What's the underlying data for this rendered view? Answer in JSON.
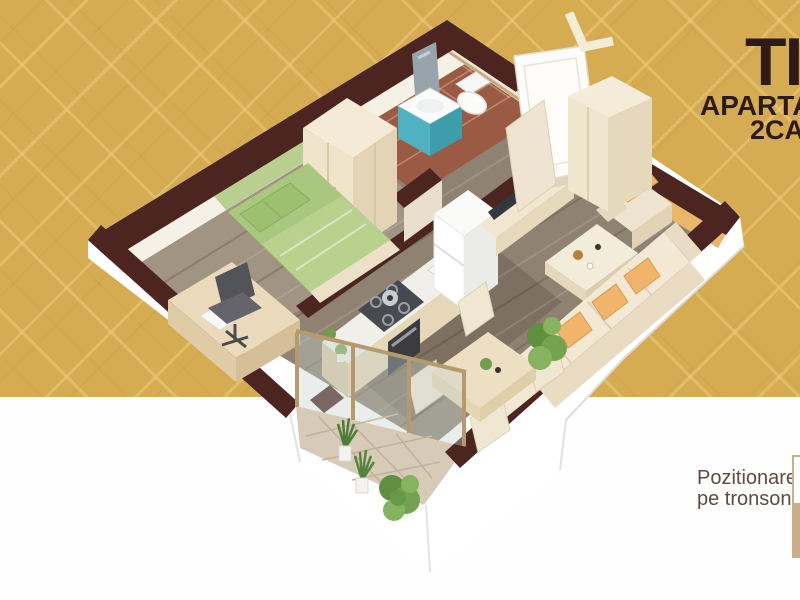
{
  "page": {
    "background_top_color": "#d6ac52",
    "background_bottom_color": "#fefefe",
    "background_pattern": "concentric-diamond-lattice",
    "split_y_px": 397
  },
  "header": {
    "title": "TIP",
    "subtitle_line1": "APARTAM",
    "subtitle_line2": "2CAM",
    "text_color": "#2e1a19",
    "note": "text is cropped by right edge of image"
  },
  "footer": {
    "label_line1": "Pozitionare",
    "label_line2": "pe tronson",
    "text_color": "#5d4b44",
    "tronson_marker_color": "#c9ae8a"
  },
  "floor_plan": {
    "type": "3d-isometric-apartment-render",
    "wall_cap_color": "#4c2420",
    "outer_wall_color": "#ffffff",
    "wood_floor_color": "#8f8273",
    "entrance_marker": "white-chevron-arrow",
    "rooms": [
      {
        "name": "bedroom",
        "floor": "wood",
        "furniture": [
          "wardrobe",
          "double-bed-green",
          "green-accent-wall",
          "desk",
          "laptop",
          "office-chair"
        ]
      },
      {
        "name": "bathroom",
        "floor": "terracotta-tile",
        "tile_color": "#9b5a43",
        "furniture": [
          "teal-vanity-sink",
          "mirror",
          "toilet"
        ],
        "vanity_color": "#4eb2c0"
      },
      {
        "name": "hallway",
        "floor": "wood",
        "furniture": [
          "entry-door-open",
          "bathroom-door",
          "tall-cabinet"
        ]
      },
      {
        "name": "kitchen",
        "floor": "wood",
        "furniture": [
          "counter",
          "gas-hob",
          "oven",
          "sink",
          "fridge",
          "potted-plants"
        ]
      },
      {
        "name": "living-room",
        "floor": "wood",
        "accent_wall_color": "#e9b768",
        "furniture": [
          "tv-half-wall",
          "tv",
          "tv-cabinet",
          "coffee-table",
          "corner-sofa-cream",
          "orange-cushions",
          "armchair",
          "plant"
        ],
        "cushion_color": "#f0b46a"
      },
      {
        "name": "dining-area",
        "floor": "wood",
        "furniture": [
          "square-table",
          "chair",
          "chair",
          "chair",
          "chair",
          "large-plant"
        ]
      },
      {
        "name": "balcony",
        "floor": "beige-tile",
        "tile_color": "#d7cab6",
        "furniture": [
          "glass-sliding-doors",
          "snake-plant",
          "snake-plant",
          "leafy-plant",
          "white-parapet"
        ]
      }
    ]
  }
}
